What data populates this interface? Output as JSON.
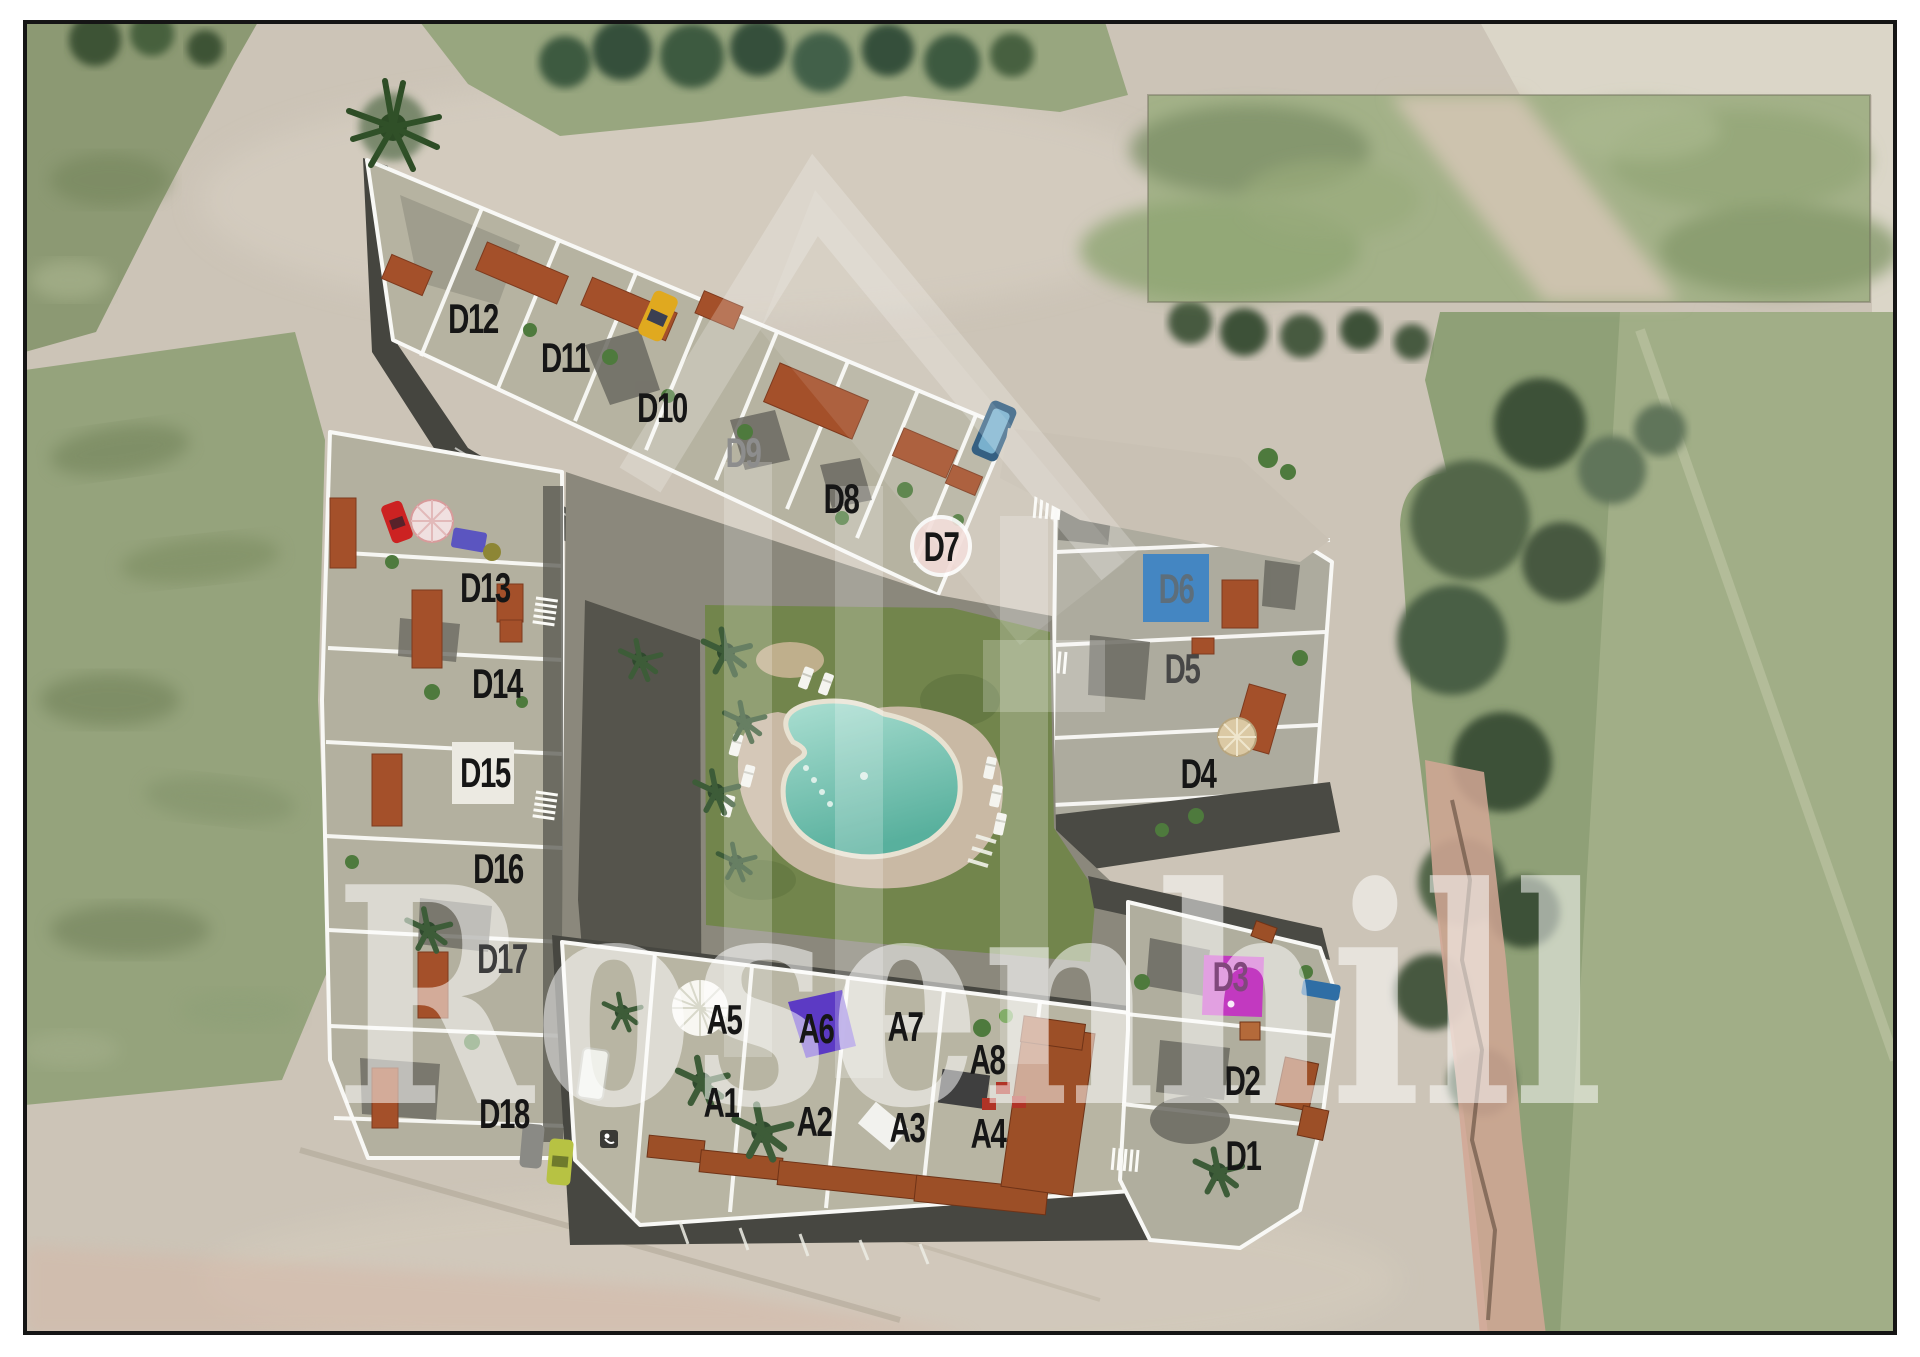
{
  "watermark": {
    "text": "Rosenhill",
    "color": "#ffffff"
  },
  "palette": {
    "road": "#ccc4b7",
    "terrace": "#b6b3a1",
    "dark_street": "#45453f",
    "tile_roof": "#a0502a",
    "lawn": "#72854c",
    "pool_water": "#7cc9b8",
    "pool_deck": "#c9b9a4",
    "field_green": "#93a17b",
    "tree_green": "#3e5a41"
  },
  "highlights": {
    "d6": {
      "unit": "D6",
      "color": "#4486c2"
    },
    "d3": {
      "unit": "D3",
      "color": "#c239c0"
    },
    "a6": {
      "unit": "A6",
      "color": "#5634c6"
    },
    "d7": {
      "unit": "D7",
      "color": "#f2dcd8"
    }
  },
  "units": [
    {
      "id": "D12",
      "x": 473,
      "y": 318,
      "color": "#161616"
    },
    {
      "id": "D11",
      "x": 565,
      "y": 357,
      "color": "#161616"
    },
    {
      "id": "D10",
      "x": 662,
      "y": 407,
      "color": "#161616"
    },
    {
      "id": "D9",
      "x": 743,
      "y": 452,
      "color": "#8d8d8d"
    },
    {
      "id": "D8",
      "x": 841,
      "y": 498,
      "color": "#161616"
    },
    {
      "id": "D7",
      "x": 941,
      "y": 546,
      "color": "#161616"
    },
    {
      "id": "D6",
      "x": 1176,
      "y": 588,
      "color": "#5d6e7b"
    },
    {
      "id": "D5",
      "x": 1182,
      "y": 668,
      "color": "#474747"
    },
    {
      "id": "D4",
      "x": 1198,
      "y": 773,
      "color": "#161616"
    },
    {
      "id": "D13",
      "x": 485,
      "y": 587,
      "color": "#161616"
    },
    {
      "id": "D14",
      "x": 497,
      "y": 683,
      "color": "#161616"
    },
    {
      "id": "D15",
      "x": 485,
      "y": 772,
      "color": "#161616"
    },
    {
      "id": "D16",
      "x": 498,
      "y": 868,
      "color": "#161616"
    },
    {
      "id": "D17",
      "x": 502,
      "y": 958,
      "color": "#3d3d3d"
    },
    {
      "id": "D18",
      "x": 504,
      "y": 1113,
      "color": "#161616"
    },
    {
      "id": "A5",
      "x": 724,
      "y": 1019,
      "color": "#161616"
    },
    {
      "id": "A6",
      "x": 816,
      "y": 1028,
      "color": "#161616"
    },
    {
      "id": "A7",
      "x": 905,
      "y": 1026,
      "color": "#161616"
    },
    {
      "id": "A8",
      "x": 987,
      "y": 1059,
      "color": "#161616"
    },
    {
      "id": "A1",
      "x": 721,
      "y": 1102,
      "color": "#161616"
    },
    {
      "id": "A2",
      "x": 814,
      "y": 1121,
      "color": "#161616"
    },
    {
      "id": "A3",
      "x": 907,
      "y": 1127,
      "color": "#161616"
    },
    {
      "id": "A4",
      "x": 988,
      "y": 1133,
      "color": "#161616"
    },
    {
      "id": "D3",
      "x": 1230,
      "y": 976,
      "color": "#80487c"
    },
    {
      "id": "D2",
      "x": 1242,
      "y": 1080,
      "color": "#161616"
    },
    {
      "id": "D1",
      "x": 1243,
      "y": 1155,
      "color": "#161616"
    }
  ]
}
